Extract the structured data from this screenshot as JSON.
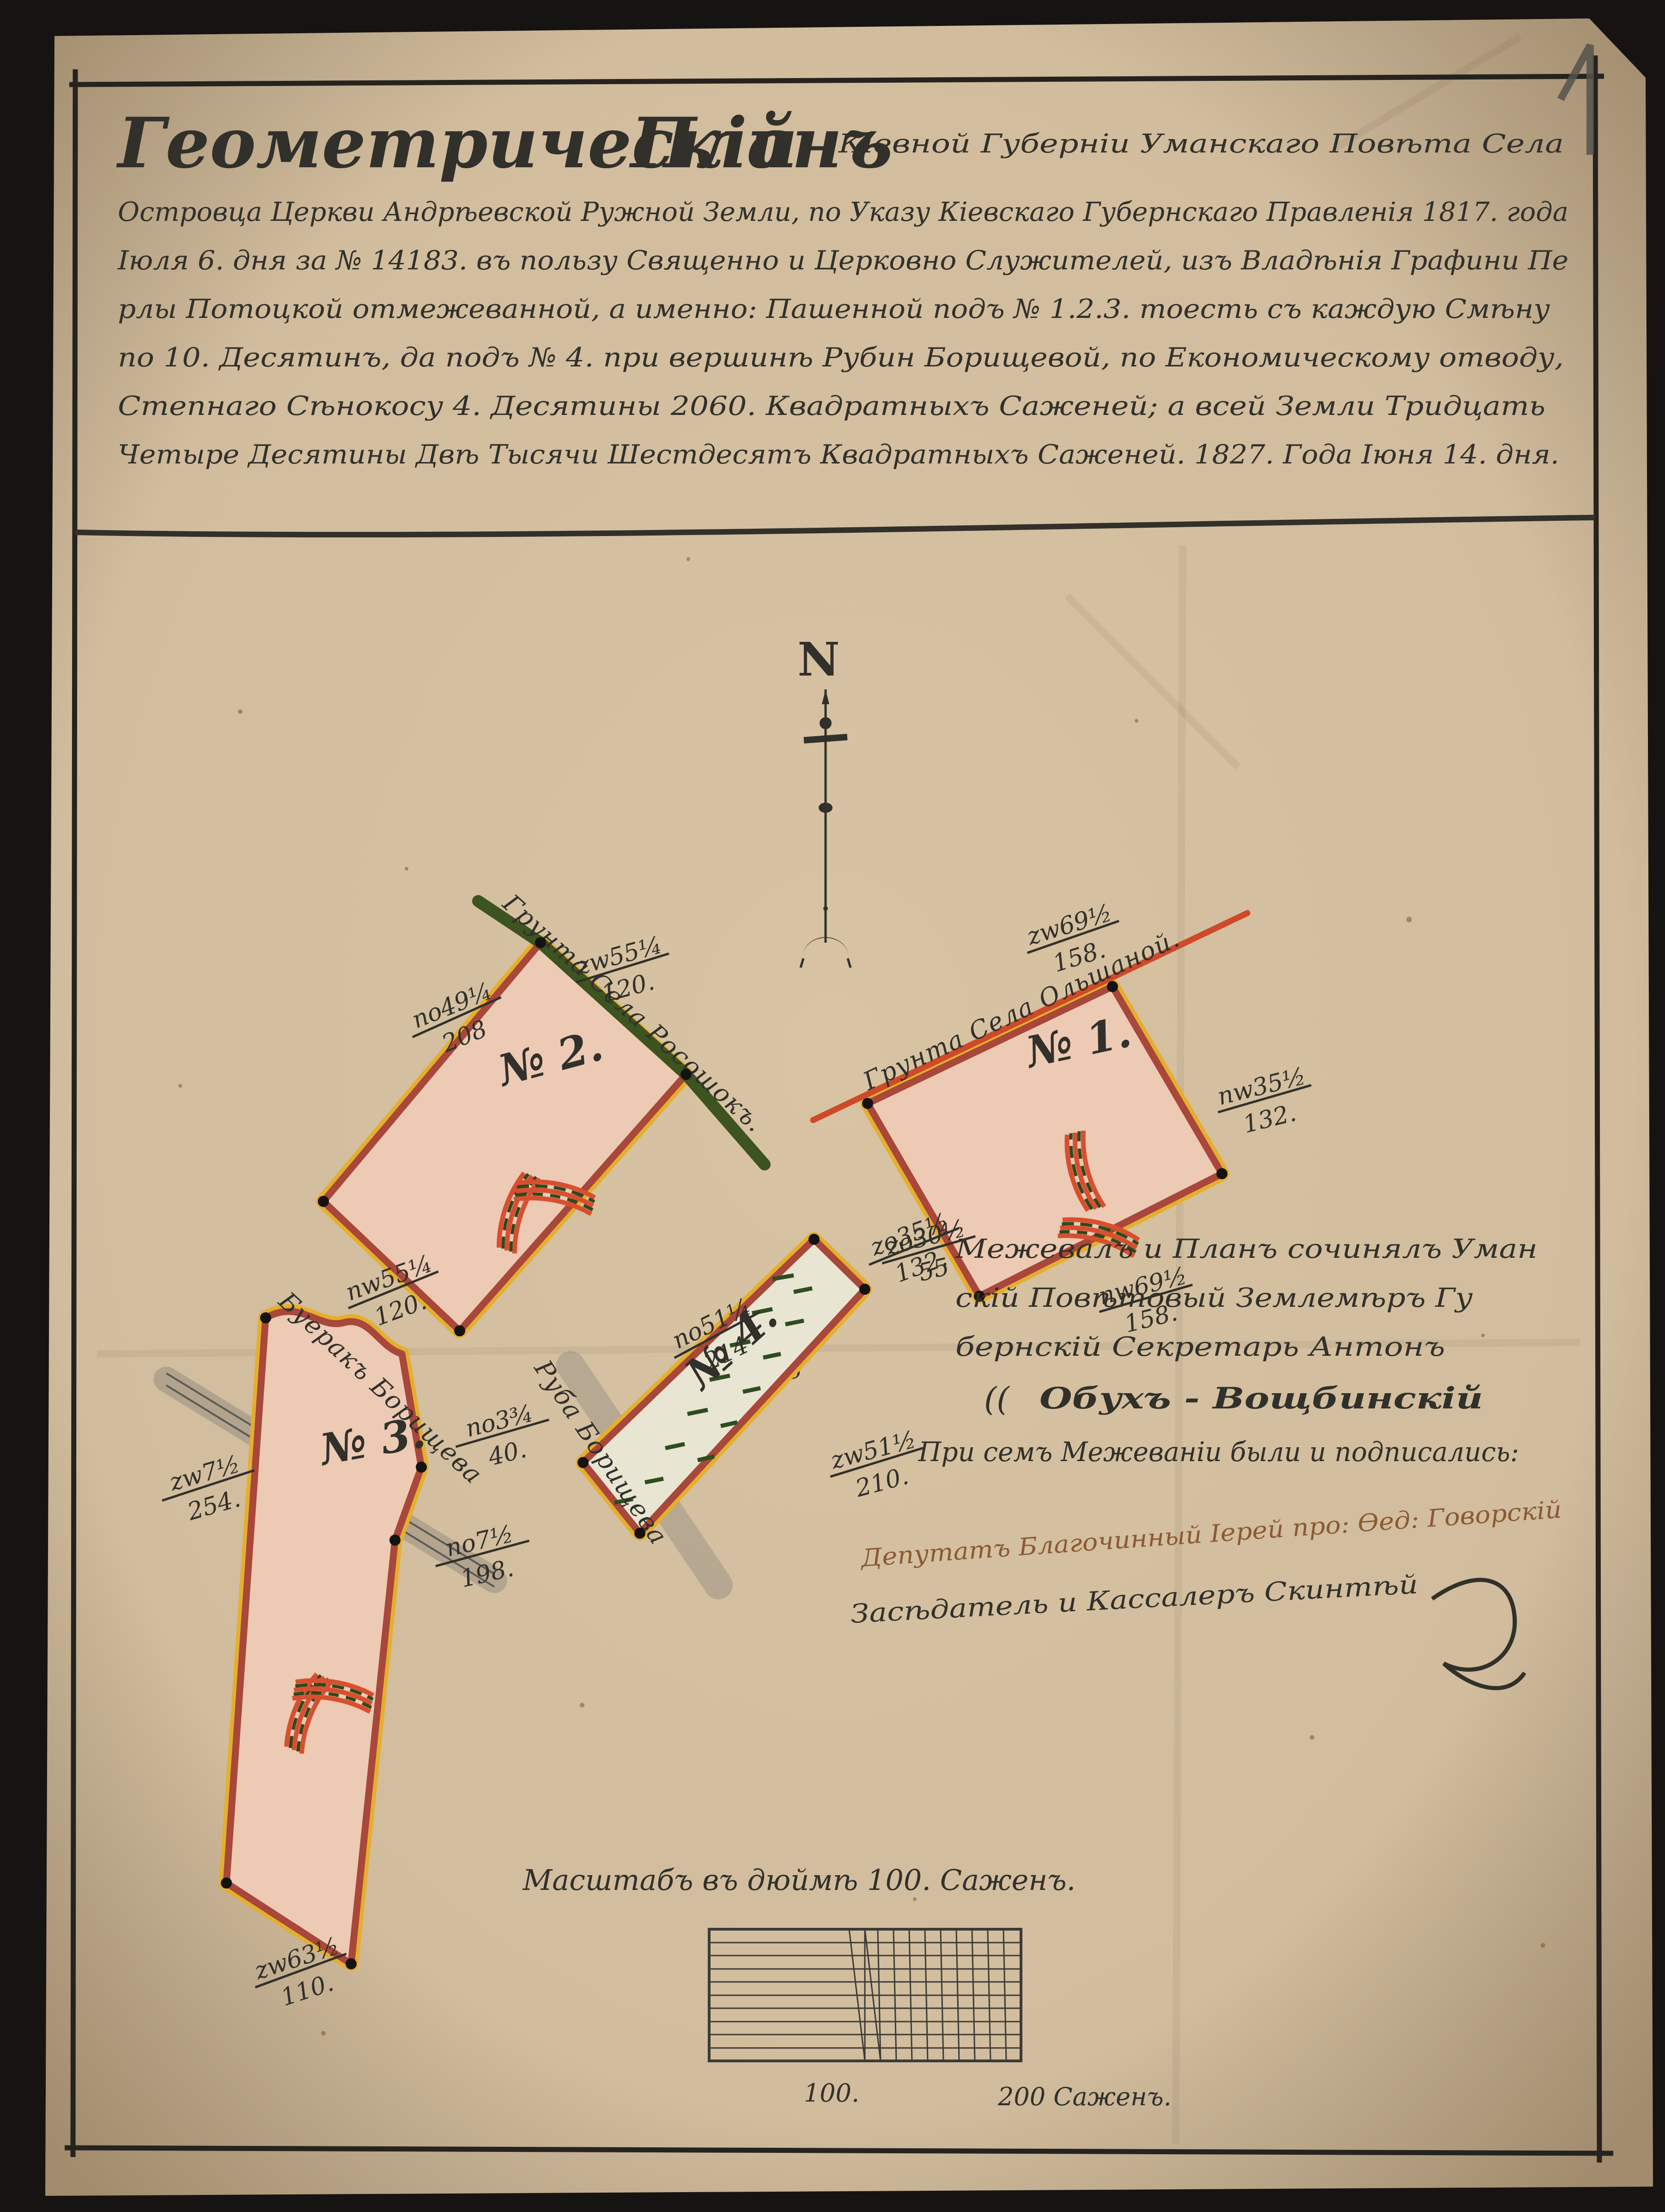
{
  "palette": {
    "paper": "#d8c3a3",
    "ink": "#31302b",
    "frame": "#26231f",
    "parcel_fill": "#eccab4",
    "parcel_fill_meadow": "#e9e5d3",
    "border_yellow": "#e5af2e",
    "border_crimson": "#a8473a",
    "road_green": "#3d5320",
    "road_red": "#cf4a28",
    "meadow_green": "#2f4d1f",
    "signature_brown": "#8a5a33"
  },
  "page": {
    "number": "1"
  },
  "header": {
    "title_word1": "Геометрическій",
    "title_word2": "Планъ",
    "title_line1_rest": "Кіевной Губерніи Уманскаго Повѣта Села",
    "lines": [
      "Островца Церкви Андрѣевской Ружной Земли, по Указу Кіевскаго Губернскаго Правленія 1817. года",
      "Іюля 6. дня за № 14183. въ пользу Священно и Церковно Служителей, изъ Владѣнія Графини Пе",
      "рлы Потоцкой отмежеванной, а именно: Пашенной подъ № 1.2.3. тоесть съ каждую Смѣну",
      "по 10. Десятинъ, да подъ № 4. при вершинѣ Рубин Борищевой, по Економическому отводу,",
      "Степнаго Сѣнокосу 4. Десятины 2060. Квадратныхъ Саженей; а всей Земли Тридцать",
      "Четыре Десятины Двѣ Тысячи Шестдесятъ Квадратныхъ Саженей. 1827. Года Іюня 14. дня."
    ]
  },
  "compass": {
    "label": "N"
  },
  "parcels": [
    {
      "label": "№ 1.",
      "adjacent": "Грунта Села Ольшаной.",
      "bearings": [
        {
          "n": "zw69½",
          "d": "158."
        },
        {
          "n": "nw35½",
          "d": "132."
        },
        {
          "n": "zo35½",
          "d": "132."
        },
        {
          "n": "nw69½",
          "d": "158."
        }
      ]
    },
    {
      "label": "№ 2.",
      "adjacent": "Грунта Села Росошокъ.",
      "bearings": [
        {
          "n": "zw55¼",
          "d": "120."
        },
        {
          "n": "no49¼",
          "d": "208"
        },
        {
          "n": "nw55¼",
          "d": "120."
        },
        {
          "n": "zw49¼",
          "d": "208"
        }
      ]
    },
    {
      "label": "№ 3.",
      "adjacent": "Буеракъ Борищева",
      "bearings": [
        {
          "n": "zw7½",
          "d": "254."
        },
        {
          "n": "no3¾",
          "d": "40."
        },
        {
          "n": "no7½",
          "d": "198."
        },
        {
          "n": "zw63½",
          "d": "110."
        }
      ]
    },
    {
      "label": "№ 4.",
      "adjacent": "Руба Борищева",
      "bearings": [
        {
          "n": "no51¼",
          "d": "214"
        },
        {
          "n": "zo30½",
          "d": "55"
        },
        {
          "n": "zw51½",
          "d": "210."
        }
      ]
    }
  ],
  "surveyor": {
    "lines": [
      "Межевалъ и Планъ сочинялъ Уман",
      "скій Повѣтовый Землемѣръ Гу",
      "бернскій Секретарь Антонъ"
    ],
    "flourish": "((",
    "signature": "Обухъ - Вощбинскій",
    "witness_line": "При семъ Межеваніи были и подписались:"
  },
  "signatures": {
    "deputy": "Депутатъ Благочинный Іерей про: Ѳед: Говорскій",
    "assessor": "Засѣдатель и Кассалеръ Скинтѣй"
  },
  "scale": {
    "caption": "Масштабъ въ дюймѣ 100. Саженъ.",
    "mid_label": "100.",
    "end_label": "200 Саженъ."
  }
}
